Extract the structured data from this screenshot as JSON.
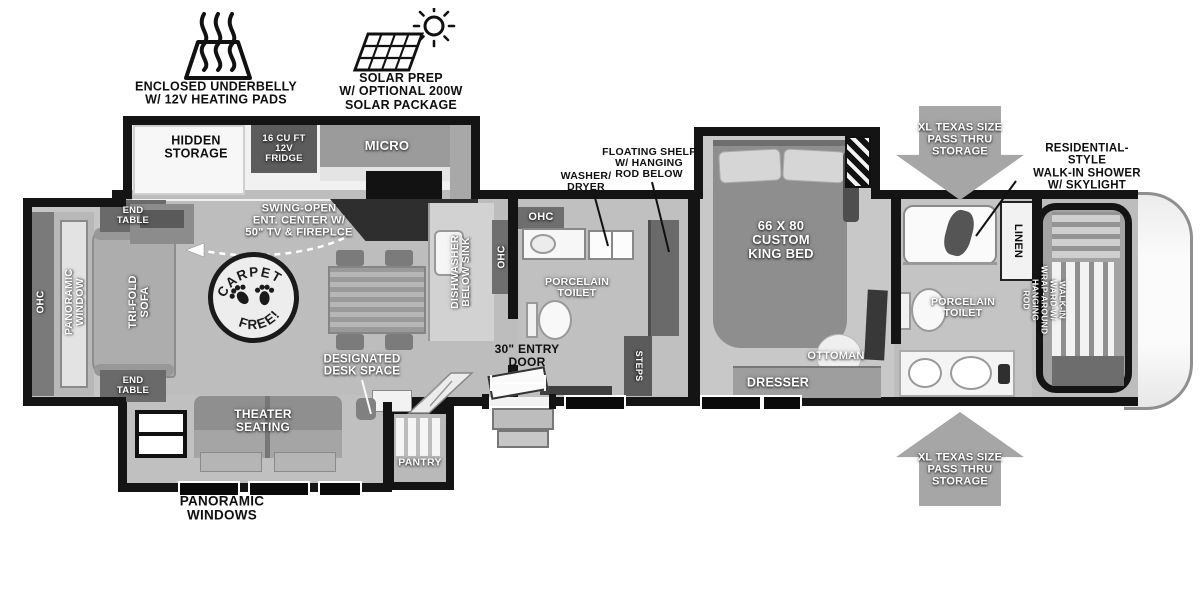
{
  "colors": {
    "wall": "#141414",
    "floor": "#bdbdbd",
    "arrow_gray": "#a6a6a6",
    "fixture_white": "#f7f7f7",
    "text_dark": "#0f0f0f",
    "text_light": "#ffffff"
  },
  "exterior": {
    "underbelly": "ENCLOSED UNDERBELLY\nW/ 12V HEATING PADS",
    "solar": "SOLAR PREP\nW/ OPTIONAL 200W\nSOLAR PACKAGE",
    "pass_thru_top": "XL TEXAS SIZE\nPASS THRU\nSTORAGE",
    "pass_thru_bottom": "XL TEXAS SIZE\nPASS THRU\nSTORAGE",
    "panoramic_windows": "PANORAMIC\nWINDOWS"
  },
  "living": {
    "hidden_storage": "HIDDEN\nSTORAGE",
    "fridge": "16 CU FT\n12V\nFRIDGE",
    "micro": "MICRO",
    "swing_open": "SWING-OPEN\nENT. CENTER W/\n50\" TV & FIREPLCE",
    "end_table_top": "END\nTABLE",
    "end_table_bottom": "END\nTABLE",
    "ohc": "OHC",
    "panoramic_window": "PANORAMIC\nWINDOW",
    "trifold_sofa": "TRI-FOLD\nSOFA",
    "badge_top": "CARPET",
    "badge_bottom": "FREE!",
    "desk": "DESIGNATED\nDESK SPACE",
    "theater": "THEATER\nSEATING",
    "pantry": "PANTRY",
    "entry_door": "30\" ENTRY\nDOOR"
  },
  "kitchen": {
    "dishwasher": "DISHWASHER\nBELOW SINK",
    "ohc": "OHC"
  },
  "mid_bath": {
    "ohc": "OHC",
    "washer_dryer": "WASHER/\nDRYER",
    "floating_shelf": "FLOATING SHELF\nW/ HANGING\nROD BELOW",
    "toilet": "PORCELAIN\nTOILET",
    "steps": "STEPS"
  },
  "bedroom": {
    "bed": "66 X 80\nCUSTOM\nKING BED",
    "ottoman": "OTTOMAN",
    "dresser": "DRESSER"
  },
  "front_bath": {
    "shower": "RESIDENTIAL-STYLE\nWALK-IN SHOWER\nW/ SKYLIGHT",
    "linen": "LINEN",
    "toilet": "PORCELAIN\nTOILET"
  },
  "wardrobe": {
    "label": "WALK-IN\nWARD W/\nWRAP-AROUND\nHANGING\nROD"
  }
}
